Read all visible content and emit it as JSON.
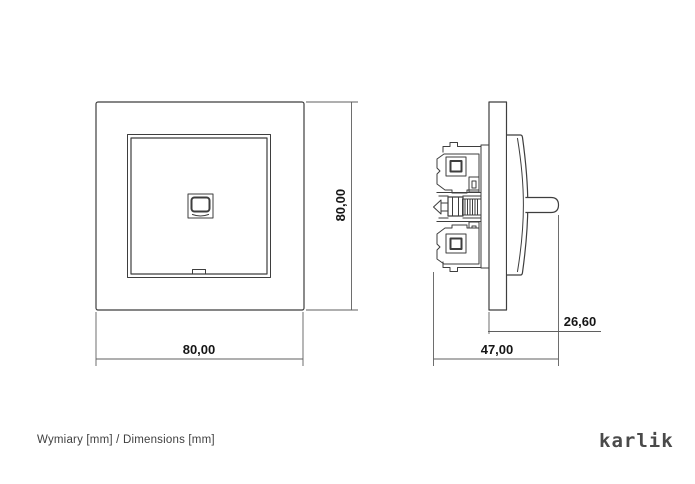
{
  "colors": {
    "background": "#ffffff",
    "line": "#3e3e3e",
    "dimension_line": "#5f5f5f",
    "dimension_text": "#161616",
    "caption_text": "#3f3f3f",
    "logo": "#4a4a4a"
  },
  "front_view": {
    "width_dim": "80,00",
    "height_dim": "80,00"
  },
  "side_view": {
    "depth_dim": "47,00",
    "protrusion_dim": "26,60"
  },
  "footer": {
    "caption": "Wymiary [mm] / Dimensions [mm]",
    "brand": "karlik"
  }
}
